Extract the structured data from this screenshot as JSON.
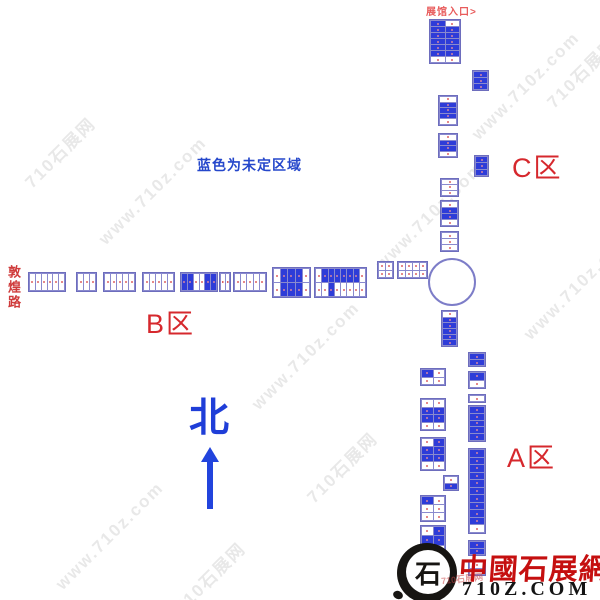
{
  "labels": {
    "entrance": "展馆入口>",
    "legend": "蓝色为未定区域",
    "road": "敦煌路",
    "zone_a": "A区",
    "zone_b": "B区",
    "zone_c": "C区",
    "north": "北"
  },
  "logo": {
    "mark_glyph": "石",
    "name": "中國石展網",
    "domain": "710Z.COM",
    "chop": "710石展网"
  },
  "colors": {
    "booth_blue": "#2e3cd8",
    "booth_border": "#8a8ace",
    "zone_red": "#d6282d",
    "legend_blue": "#2547cb",
    "north_blue": "#2244dd",
    "logo_red": "#c50f0f",
    "circle_border": "#7d7dc8"
  },
  "watermarks": [
    {
      "text": "710石展网",
      "x": 18,
      "y": 175
    },
    {
      "text": "www.710z.com",
      "x": 95,
      "y": 235
    },
    {
      "text": "www.710z.com",
      "x": 468,
      "y": 130
    },
    {
      "text": "710石展网",
      "x": 540,
      "y": 95
    },
    {
      "text": "www.710z.com",
      "x": 372,
      "y": 260
    },
    {
      "text": "www.710z.com",
      "x": 248,
      "y": 400
    },
    {
      "text": "710石展网",
      "x": 300,
      "y": 490
    },
    {
      "text": "www.710z.com",
      "x": 52,
      "y": 580
    },
    {
      "text": "710石展网",
      "x": 168,
      "y": 600
    },
    {
      "text": "www.710z.com",
      "x": 520,
      "y": 330
    }
  ],
  "map": {
    "circle": {
      "x": 428,
      "y": 258,
      "d": 48
    },
    "blocks": [
      {
        "x": 429,
        "y": 19,
        "w": 32,
        "h": 45,
        "rows": [
          "bw",
          "bb",
          "bb",
          "bb",
          "bb",
          "bb",
          "ww"
        ]
      },
      {
        "x": 472,
        "y": 70,
        "w": 17,
        "h": 21,
        "rows": [
          "b",
          "b",
          "b"
        ]
      },
      {
        "x": 438,
        "y": 95,
        "w": 20,
        "h": 31,
        "rows": [
          "w",
          "b",
          "b",
          "b",
          "w"
        ]
      },
      {
        "x": 438,
        "y": 133,
        "w": 20,
        "h": 25,
        "rows": [
          "w",
          "b",
          "b",
          "w"
        ]
      },
      {
        "x": 474,
        "y": 155,
        "w": 15,
        "h": 22,
        "rows": [
          "b",
          "b",
          "b"
        ]
      },
      {
        "x": 440,
        "y": 178,
        "w": 19,
        "h": 19,
        "rows": [
          "w",
          "w",
          "w"
        ]
      },
      {
        "x": 440,
        "y": 200,
        "w": 19,
        "h": 27,
        "rows": [
          "w",
          "b",
          "b",
          "w"
        ]
      },
      {
        "x": 440,
        "y": 231,
        "w": 19,
        "h": 21,
        "rows": [
          "w",
          "w",
          "w"
        ]
      },
      {
        "x": 408,
        "y": 262,
        "w": 14,
        "h": 15,
        "rows": [
          "w"
        ]
      },
      {
        "x": 441,
        "y": 310,
        "w": 17,
        "h": 37,
        "rows": [
          "w",
          "b",
          "b",
          "b",
          "b",
          "b"
        ]
      },
      {
        "x": 28,
        "y": 272,
        "w": 38,
        "h": 20,
        "rows": [
          "wwwwww"
        ]
      },
      {
        "x": 76,
        "y": 272,
        "w": 21,
        "h": 20,
        "rows": [
          "www"
        ]
      },
      {
        "x": 103,
        "y": 272,
        "w": 33,
        "h": 20,
        "rows": [
          "wwwww"
        ]
      },
      {
        "x": 142,
        "y": 272,
        "w": 33,
        "h": 20,
        "rows": [
          "wwwww"
        ]
      },
      {
        "x": 180,
        "y": 272,
        "w": 38,
        "h": 20,
        "rows": [
          "bbwwbb"
        ]
      },
      {
        "x": 219,
        "y": 272,
        "w": 12,
        "h": 20,
        "rows": [
          "ww"
        ]
      },
      {
        "x": 233,
        "y": 272,
        "w": 34,
        "h": 20,
        "rows": [
          "wwwww"
        ]
      },
      {
        "x": 272,
        "y": 267,
        "w": 39,
        "h": 31,
        "rows": [
          "wbbbw",
          "wbbbw"
        ]
      },
      {
        "x": 314,
        "y": 267,
        "w": 53,
        "h": 31,
        "rows": [
          "wbbbbbbw",
          "wwbwwwww"
        ]
      },
      {
        "x": 377,
        "y": 261,
        "w": 17,
        "h": 18,
        "rows": [
          "ww",
          "ww"
        ]
      },
      {
        "x": 397,
        "y": 261,
        "w": 31,
        "h": 18,
        "rows": [
          "wwww",
          "wwww"
        ]
      },
      {
        "x": 420,
        "y": 368,
        "w": 26,
        "h": 18,
        "rows": [
          "bw",
          "ww"
        ]
      },
      {
        "x": 420,
        "y": 398,
        "w": 26,
        "h": 33,
        "rows": [
          "ww",
          "bb",
          "bb",
          "ww"
        ]
      },
      {
        "x": 420,
        "y": 437,
        "w": 26,
        "h": 34,
        "rows": [
          "wb",
          "bb",
          "bb",
          "ww"
        ]
      },
      {
        "x": 443,
        "y": 475,
        "w": 16,
        "h": 16,
        "rows": [
          "w",
          "b"
        ]
      },
      {
        "x": 420,
        "y": 495,
        "w": 26,
        "h": 27,
        "rows": [
          "bw",
          "ww",
          "ww"
        ]
      },
      {
        "x": 420,
        "y": 525,
        "w": 26,
        "h": 31,
        "rows": [
          "wb",
          "bb",
          "ww"
        ]
      },
      {
        "x": 420,
        "y": 558,
        "w": 26,
        "h": 13,
        "rows": [
          "ww"
        ]
      },
      {
        "x": 468,
        "y": 352,
        "w": 18,
        "h": 15,
        "rows": [
          "b",
          "b"
        ]
      },
      {
        "x": 468,
        "y": 371,
        "w": 18,
        "h": 18,
        "rows": [
          "b",
          "w"
        ]
      },
      {
        "x": 468,
        "y": 394,
        "w": 18,
        "h": 9,
        "rows": [
          "w"
        ]
      },
      {
        "x": 468,
        "y": 405,
        "w": 18,
        "h": 37,
        "rows": [
          "b",
          "b",
          "b",
          "b",
          "b"
        ]
      },
      {
        "x": 468,
        "y": 448,
        "w": 18,
        "h": 86,
        "rows": [
          "b",
          "b",
          "b",
          "b",
          "b",
          "b",
          "b",
          "b",
          "b",
          "b",
          "w"
        ]
      },
      {
        "x": 468,
        "y": 540,
        "w": 18,
        "h": 16,
        "rows": [
          "b",
          "b"
        ]
      },
      {
        "x": 468,
        "y": 560,
        "w": 18,
        "h": 16,
        "rows": [
          "w",
          "w"
        ]
      }
    ]
  }
}
